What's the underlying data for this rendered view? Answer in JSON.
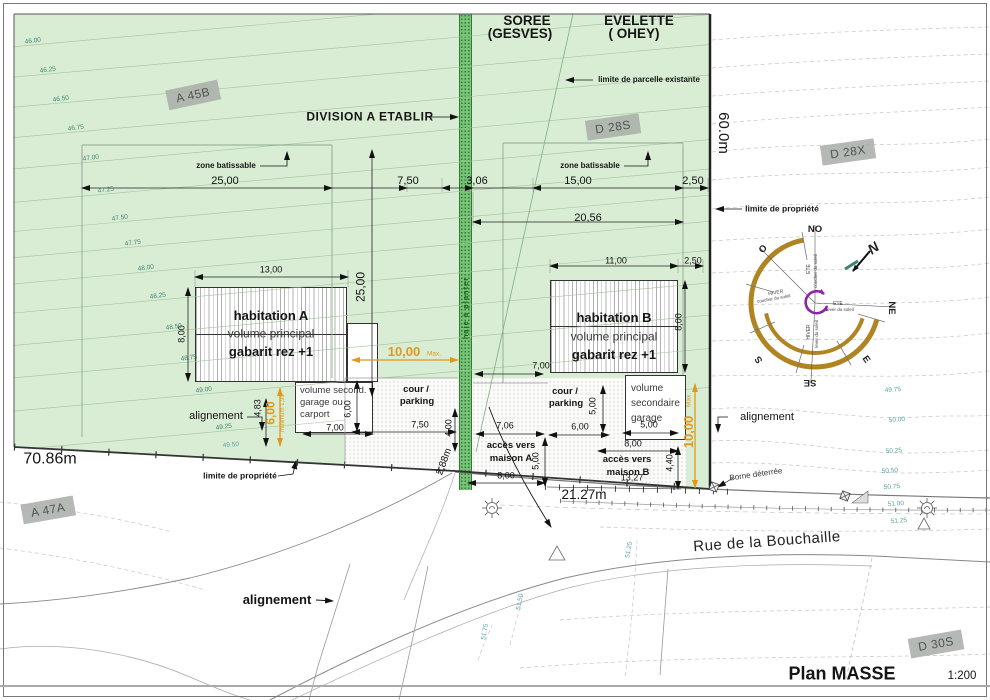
{
  "page": {
    "title": "Plan MASSE",
    "scale": "1:200"
  },
  "localities": {
    "left": "SOREE",
    "left_sub": "(GESVES)",
    "right": "EVELETTE",
    "right_sub": "( OHEY)"
  },
  "parcels": {
    "a45b": "A 45B",
    "d28s": "D 28S",
    "d28x": "D 28X",
    "a47a": "A 47A",
    "d30s": "D 30S"
  },
  "boundaries": {
    "west_length": "70.86m",
    "east_length": "60.0m",
    "front_length": "21.27m",
    "street": "Rue de la Bouchaille"
  },
  "notes": {
    "division": "DIVISION A ETABLIR",
    "limite_parcelle": "limite de parcelle existante",
    "limite_propriete": "limite de propriété",
    "alignement": "alignement",
    "borne": "Borne déterrée",
    "zone_batissable": "zone batissable",
    "haie": "haie à planter"
  },
  "buildings": {
    "hab_a": {
      "l1": "habitation A",
      "l2": "volume principal",
      "l3": "gabarit rez +1"
    },
    "hab_b": {
      "l1": "habitation B",
      "l2": "volume principal",
      "l3": "gabarit rez +1"
    },
    "annex_a": {
      "l1": "volume second.",
      "l2": "garage ou",
      "l3": "carport"
    },
    "annex_b": {
      "l1": "volume",
      "l2": "secondaire",
      "l3": "garage"
    },
    "cour": {
      "l1": "cour /",
      "l2": "parking"
    },
    "acces_a": {
      "l1": "accès vers",
      "l2": "maison A"
    },
    "acces_b": {
      "l1": "accès vers",
      "l2": "maison B"
    }
  },
  "compass": {
    "north": "N",
    "no": "NO",
    "o": "O",
    "s": "S",
    "se": "SE",
    "ne": "NE",
    "e": "E",
    "hiver": "HIVER",
    "ete": "ETE",
    "lever": "lever du soleil",
    "coucher": "coucher du soleil"
  },
  "dim_labels": [
    {
      "v": "25,00",
      "x": 225,
      "y": 182,
      "s": 11
    },
    {
      "v": "7,50",
      "x": 408,
      "y": 182,
      "s": 11
    },
    {
      "v": "3,06",
      "x": 477,
      "y": 182,
      "s": 11
    },
    {
      "v": "15,00",
      "x": 578,
      "y": 182,
      "s": 11
    },
    {
      "v": "2,50",
      "x": 693,
      "y": 182,
      "s": 11
    },
    {
      "v": "20,56",
      "x": 588,
      "y": 219,
      "s": 11
    },
    {
      "v": "13,00",
      "x": 271,
      "y": 270
    },
    {
      "v": "8,00",
      "x": 182,
      "y": 334,
      "r": -90
    },
    {
      "v": "25,00",
      "x": 361,
      "y": 287,
      "r": -90,
      "s": 12
    },
    {
      "v": "11,00",
      "x": 616,
      "y": 261
    },
    {
      "v": "2,50",
      "x": 693,
      "y": 261
    },
    {
      "v": "8,00",
      "x": 679,
      "y": 322,
      "r": -90
    },
    {
      "v": "10,00",
      "x": 404,
      "y": 352,
      "c": "o",
      "s": 13
    },
    {
      "v": "Max.",
      "x": 434,
      "y": 355,
      "c": "o2"
    },
    {
      "v": "7,00",
      "x": 541,
      "y": 366
    },
    {
      "v": "6,00",
      "x": 348,
      "y": 409,
      "r": -90
    },
    {
      "v": "7,50",
      "x": 420,
      "y": 425
    },
    {
      "v": "4,00",
      "x": 449,
      "y": 428,
      "r": -90
    },
    {
      "v": "2,88m",
      "x": 445,
      "y": 462,
      "r": -70,
      "s": 10
    },
    {
      "v": "7,06",
      "x": 505,
      "y": 426
    },
    {
      "v": "5,00",
      "x": 536,
      "y": 461,
      "r": -90
    },
    {
      "v": "8,00",
      "x": 506,
      "y": 476
    },
    {
      "v": "6,00",
      "x": 580,
      "y": 427
    },
    {
      "v": "5,00",
      "x": 593,
      "y": 406,
      "r": -90
    },
    {
      "v": "5,00",
      "x": 649,
      "y": 425
    },
    {
      "v": "8,00",
      "x": 633,
      "y": 444
    },
    {
      "v": "4,40",
      "x": 670,
      "y": 463,
      "r": -90
    },
    {
      "v": "13,27",
      "x": 632,
      "y": 478
    },
    {
      "v": "10,00",
      "x": 689,
      "y": 432,
      "r": -90,
      "c": "o",
      "s": 13
    },
    {
      "v": "Max.",
      "x": 690,
      "y": 400,
      "r": -90,
      "c": "o2"
    },
    {
      "v": "4,83",
      "x": 258,
      "y": 408,
      "r": -90
    },
    {
      "v": "6,00",
      "x": 271,
      "y": 413,
      "r": -90,
      "c": "o",
      "s": 12
    },
    {
      "v": "minimum 1,90",
      "x": 283,
      "y": 413,
      "r": -90,
      "c": "o2",
      "s": 6
    },
    {
      "v": "7,00",
      "x": 335,
      "y": 428
    }
  ],
  "contour_labels_green": [
    {
      "v": "46.00",
      "x": 33,
      "y": 42
    },
    {
      "v": "46.25",
      "x": 48,
      "y": 71
    },
    {
      "v": "46.50",
      "x": 61,
      "y": 100
    },
    {
      "v": "46.75",
      "x": 76,
      "y": 129
    },
    {
      "v": "47.00",
      "x": 91,
      "y": 159
    },
    {
      "v": "47.25",
      "x": 106,
      "y": 191
    },
    {
      "v": "47.50",
      "x": 120,
      "y": 219
    },
    {
      "v": "47.75",
      "x": 133,
      "y": 244
    },
    {
      "v": "48.00",
      "x": 146,
      "y": 269
    },
    {
      "v": "48.25",
      "x": 158,
      "y": 297
    },
    {
      "v": "48.50",
      "x": 174,
      "y": 328
    },
    {
      "v": "48.75",
      "x": 189,
      "y": 359
    },
    {
      "v": "49.00",
      "x": 204,
      "y": 391
    },
    {
      "v": "49.25",
      "x": 224,
      "y": 428
    }
  ],
  "contour_labels_white": [
    {
      "v": "49.50",
      "x": 231,
      "y": 446
    },
    {
      "v": "49.75",
      "x": 893,
      "y": 391
    },
    {
      "v": "50.00",
      "x": 897,
      "y": 421
    },
    {
      "v": "50.25",
      "x": 894,
      "y": 452
    },
    {
      "v": "50.50",
      "x": 890,
      "y": 472
    },
    {
      "v": "50.75",
      "x": 892,
      "y": 488
    },
    {
      "v": "51.00",
      "x": 896,
      "y": 505
    },
    {
      "v": "51.25",
      "x": 899,
      "y": 522
    },
    {
      "v": "51.25",
      "x": 630,
      "y": 550,
      "r": -80
    },
    {
      "v": "51.50",
      "x": 521,
      "y": 602,
      "r": -80
    },
    {
      "v": "51.75",
      "x": 486,
      "y": 632,
      "r": -80
    }
  ],
  "colors": {
    "parcel_green": "#d9edd5",
    "hedge_green": "#79c379",
    "accent_orange": "#e0981c",
    "contour_teal": "#3f8573",
    "compass_gold": "#b08420",
    "compass_purple": "#8e24aa"
  }
}
